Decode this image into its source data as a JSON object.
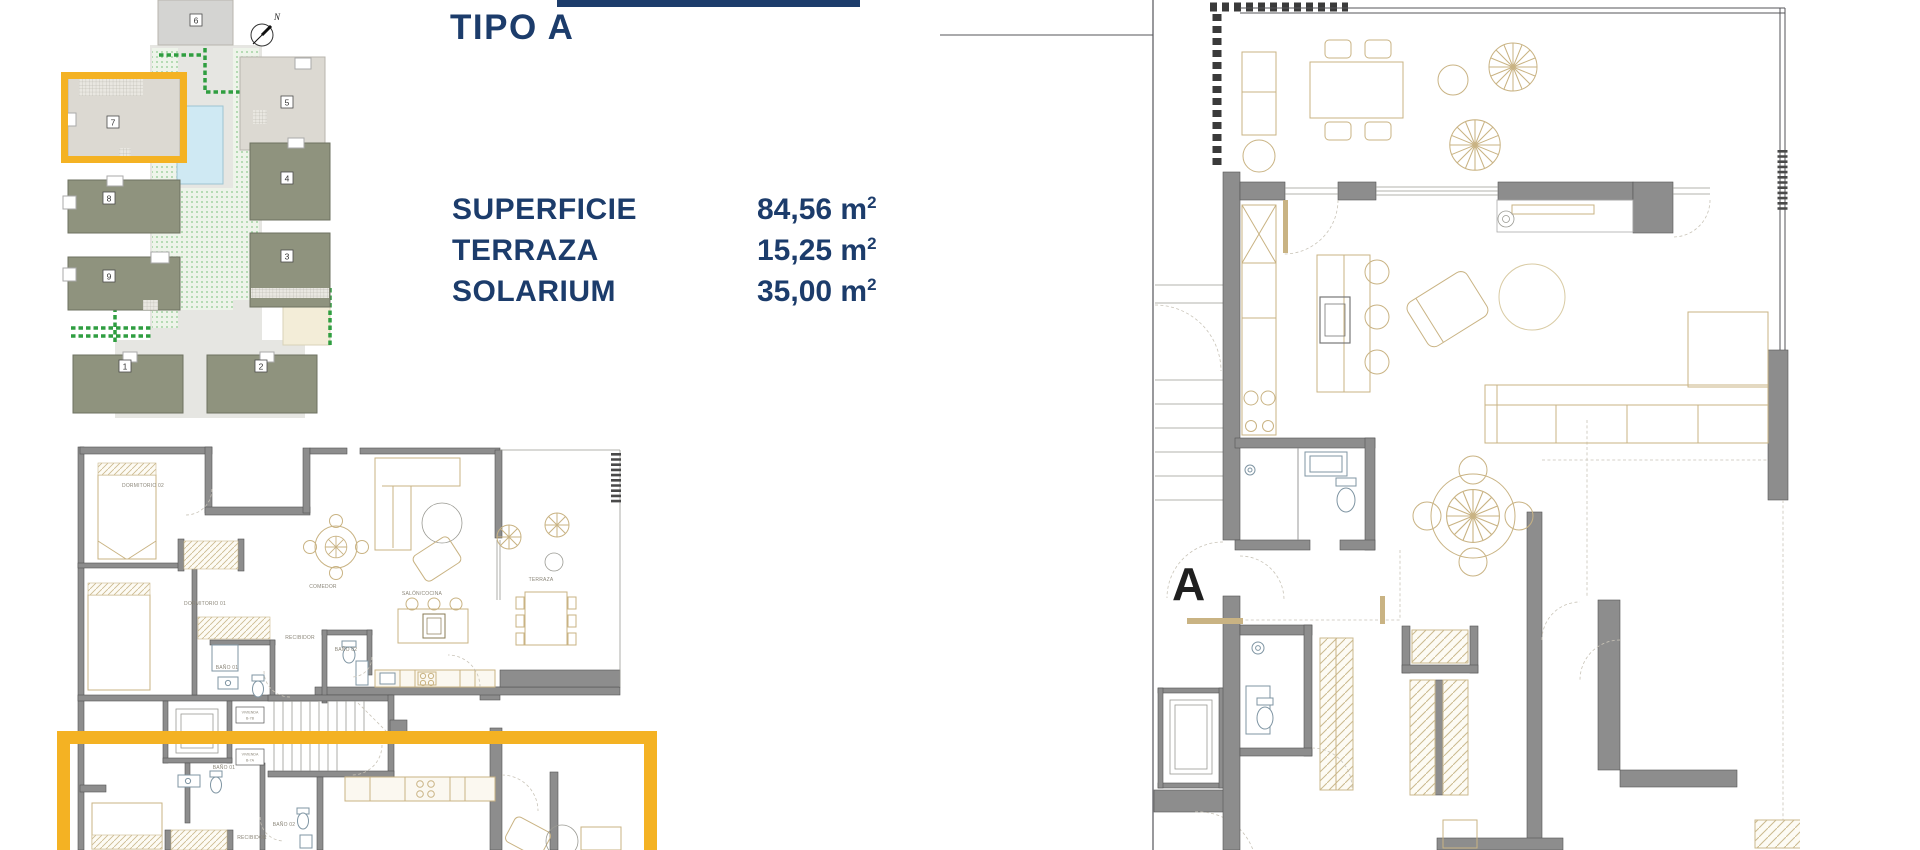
{
  "header": {
    "title": "TIPO A"
  },
  "specs": {
    "rows": [
      {
        "label": "SUPERFICIE",
        "value": "84,56",
        "unit": "m",
        "sup": "2"
      },
      {
        "label": "TERRAZA",
        "value": "15,25",
        "unit": "m",
        "sup": "2"
      },
      {
        "label": "SOLARIUM",
        "value": "35,00",
        "unit": "m",
        "sup": "2"
      }
    ]
  },
  "site_plan": {
    "compass_label": "N",
    "buildings": [
      "1",
      "2",
      "3",
      "4",
      "5",
      "6",
      "7",
      "8",
      "9"
    ],
    "highlighted_building": "7"
  },
  "floor_plan_small": {
    "rooms": {
      "dormitorio02": "DORMITORIO 02",
      "dormitorio01": "DORMITORIO 01",
      "comedor": "COMEDOR",
      "salon_cocina": "SALÓN/COCINA",
      "terraza": "TERRAZA",
      "recibidor": "RECIBIDOR",
      "bano01": "BAÑO 01",
      "bano02": "BAÑO 02"
    },
    "stair_units": [
      {
        "line1": "VIVIENDA",
        "line2": "B-7B"
      },
      {
        "line1": "VIVIENDA",
        "line2": "B-7A"
      }
    ],
    "lower_unit": {
      "bano01": "BAÑO 01",
      "bano02": "BAÑO 02",
      "recibidor": "RECIBIDOR"
    }
  },
  "floor_plan_large": {
    "unit_label": "A"
  },
  "colors": {
    "navy": "#1c3c6b",
    "highlight_yellow": "#f4b223",
    "wall_gray": "#8d8d8d",
    "furniture_tan": "#c9b383",
    "fixture_blue": "#7f95a3",
    "building_olive": "#8f937e",
    "building_light": "#dcd9d2",
    "pool_blue": "#cfe9f3",
    "landscape_green": "#2f9e40"
  }
}
